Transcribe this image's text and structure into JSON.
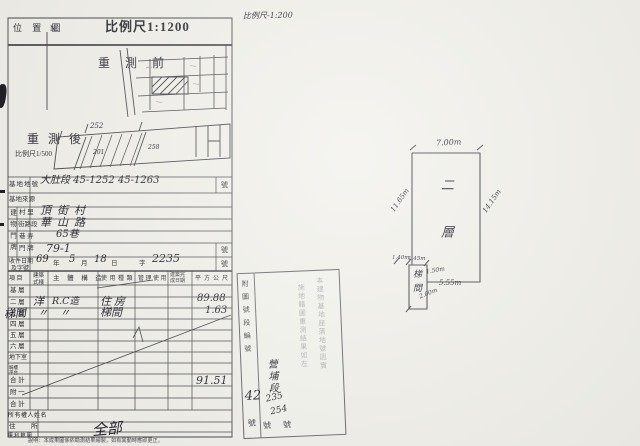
{
  "misc": {
    "scale_note_top": "比例尺-1:200"
  },
  "form": {
    "title": "位 置 圖",
    "scale": "比例尺1:1200",
    "north": "N",
    "before_label": "重 測 前",
    "after_label": "重 測 後",
    "after_scale": "比例尺1/500",
    "after_dims": {
      "n1": "252",
      "n2": "201",
      "n3": "258"
    },
    "site": {
      "parcel_label": "基地地號",
      "parcel_value": "大肚段 45-1252 45-1263",
      "parcel_suffix": "號",
      "source_label": "基地來源",
      "addr_outer": "建物門牌",
      "addr": [
        {
          "label": "村 里",
          "value": "頂街村"
        },
        {
          "label": "街路段",
          "value": "華山路"
        },
        {
          "label": "巷 弄",
          "value": "65巷"
        },
        {
          "label": "門 牌",
          "value": "79-1",
          "suffix": "號"
        }
      ],
      "receipt_label1": "收件日期",
      "receipt_label2": "及字號",
      "receipt": {
        "year": "69",
        "year_u": "年",
        "month": "5",
        "month_u": "月",
        "day": "18",
        "day_u": "日",
        "prefix": "字",
        "number": "2235",
        "suffix": "號"
      }
    },
    "table": {
      "col_item": "項 目",
      "col_style": "建築式樣",
      "col_structure": "主 體 構 造",
      "col_use": "使用種類",
      "col_manage": "管理使用",
      "col_date": "建築完成日期",
      "col_area": "平方公尺",
      "rows": [
        {
          "label": "基 層"
        },
        {
          "label": "二 層",
          "style": "洋",
          "structure": "R.C造",
          "use": "住房",
          "area": "89.88"
        },
        {
          "label": "三 層",
          "hand": "梯間",
          "style": "〃",
          "structure": "〃",
          "use": "梯間",
          "area": "1.63"
        },
        {
          "label": "四 層"
        },
        {
          "label": "五 層"
        },
        {
          "label": "六 層"
        },
        {
          "label": "地下室"
        },
        {
          "label": "騎樓平台"
        },
        {
          "label": "合 計",
          "area": "91.51"
        },
        {
          "label": "附 一"
        },
        {
          "label": "合 計"
        }
      ]
    },
    "owner": {
      "name_label": "所有權人姓名",
      "addr_left": "住",
      "addr_right": "所",
      "rights_label": "權 利 範 圍",
      "rights_value": "全部"
    },
    "footnote": "說明：本成果圖係依勘測結果繪製，如有異動時應即更正。"
  },
  "stamp": {
    "attach_col": "附圖號段編號",
    "attach_num": "42",
    "attach_unit": "號",
    "fill_section": "營埔段",
    "fill_no1": "235",
    "fill_no2": "254",
    "units": "號 號",
    "text_col1": "本建物基地座落地號因實",
    "text_col2": "施地籍圖重測結果如左"
  },
  "sketch": {
    "floor_label": "二層",
    "stair_label": "梯間",
    "dim_top": "7.00m",
    "dim_left": "11.65m",
    "dim_right": "14.15m",
    "dim_a": "1.40m",
    "dim_b": "1.45m",
    "dim_c": "1.50m",
    "dim_d": "5.55m",
    "dim_e": "2.00m"
  }
}
